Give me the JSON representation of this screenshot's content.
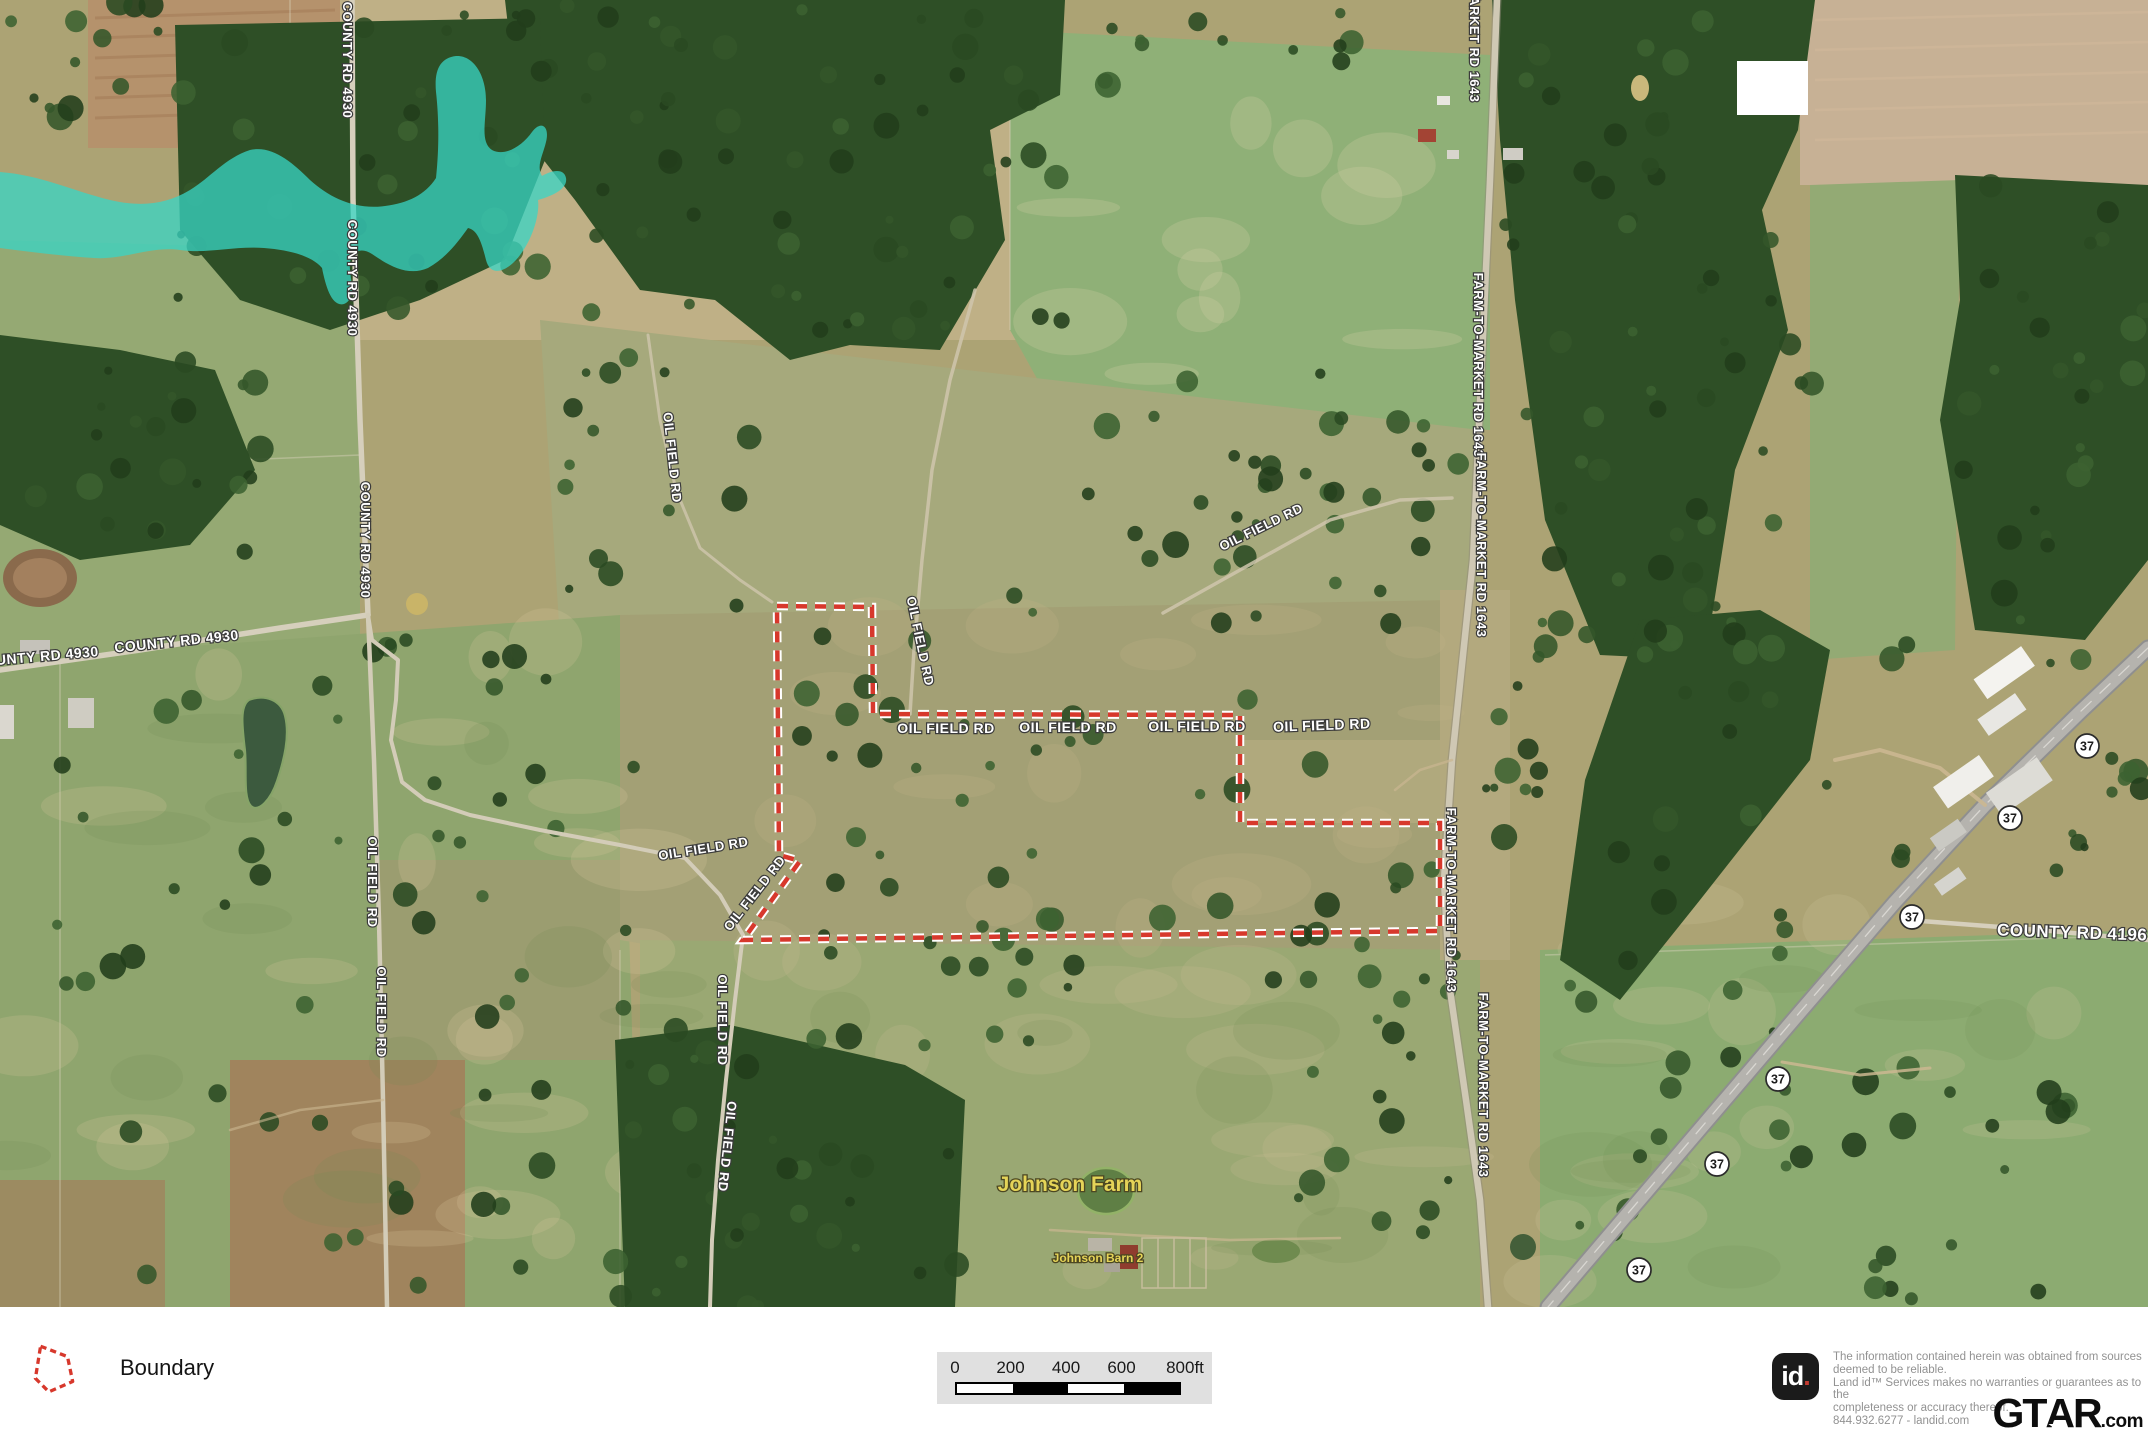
{
  "colors": {
    "boundary": "#d7382c",
    "boundary_casing": "#ffffff",
    "water": "#38d6c5",
    "road_label": "#ffffff",
    "farm_label": "#e5d458",
    "scale_bg": "#e0e0e0"
  },
  "map": {
    "boundary_points": "777,606 872,607 873,714 1240,715 1240,823 1440,823 1440,931 743,940 800,861 779,855",
    "road_labels": [
      {
        "text": "COUNTY RD 4930",
        "x": 343,
        "y": 60,
        "rot": 90,
        "size": 13
      },
      {
        "text": "COUNTY RD 4930",
        "x": 348,
        "y": 278,
        "rot": 90,
        "size": 13
      },
      {
        "text": "COUNTY RD 4930",
        "x": 361,
        "y": 540,
        "rot": 90,
        "size": 13
      },
      {
        "text": "OUNTY RD 4930",
        "x": 42,
        "y": 661,
        "rot": -5,
        "size": 14
      },
      {
        "text": "COUNTY RD 4930",
        "x": 177,
        "y": 646,
        "rot": -6,
        "size": 14
      },
      {
        "text": "OIL FIELD RD",
        "x": 368,
        "y": 882,
        "rot": 90,
        "size": 13
      },
      {
        "text": "OIL FIELD RD",
        "x": 377,
        "y": 1012,
        "rot": 90,
        "size": 13
      },
      {
        "text": "OIL FIELD RD",
        "x": 668,
        "y": 458,
        "rot": 84,
        "size": 13
      },
      {
        "text": "OIL FIELD RD",
        "x": 916,
        "y": 642,
        "rot": 78,
        "size": 13
      },
      {
        "text": "OIL FIELD RD",
        "x": 704,
        "y": 853,
        "rot": -9,
        "size": 13
      },
      {
        "text": "OIL FIELD RD",
        "x": 758,
        "y": 896,
        "rot": -52,
        "size": 13
      },
      {
        "text": "OIL FIELD RD",
        "x": 718,
        "y": 1020,
        "rot": 90,
        "size": 13
      },
      {
        "text": "OIL FIELD RD",
        "x": 723,
        "y": 1146,
        "rot": 96,
        "size": 13
      },
      {
        "text": "OIL FIELD RD",
        "x": 946,
        "y": 733,
        "rot": 0,
        "size": 14
      },
      {
        "text": "OIL FIELD RD",
        "x": 1068,
        "y": 732,
        "rot": 0,
        "size": 14
      },
      {
        "text": "OIL FIELD RD",
        "x": 1197,
        "y": 731,
        "rot": 0,
        "size": 14
      },
      {
        "text": "OIL FIELD RD",
        "x": 1322,
        "y": 730,
        "rot": -2,
        "size": 14
      },
      {
        "text": "OIL FIELD RD",
        "x": 1263,
        "y": 531,
        "rot": -26,
        "size": 13
      },
      {
        "text": "FARM-TO-MARKET RD 1643",
        "x": 1470,
        "y": 10,
        "rot": 90,
        "size": 13
      },
      {
        "text": "FARM-TO-MARKET RD 1643",
        "x": 1474,
        "y": 365,
        "rot": 90,
        "size": 13
      },
      {
        "text": "FARM-TO-MARKET RD 1643",
        "x": 1477,
        "y": 545,
        "rot": 90,
        "size": 13
      },
      {
        "text": "FARM-TO-MARKET RD 1643",
        "x": 1447,
        "y": 900,
        "rot": 90,
        "size": 13
      },
      {
        "text": "FARM-TO-MARKET RD 1643",
        "x": 1479,
        "y": 1085,
        "rot": 90,
        "size": 13
      },
      {
        "text": "COUNTY RD 4196",
        "x": 2072,
        "y": 938,
        "rot": 2,
        "size": 17
      }
    ],
    "shields": [
      {
        "num": "37",
        "x": 2087,
        "y": 746
      },
      {
        "num": "37",
        "x": 2010,
        "y": 818
      },
      {
        "num": "37",
        "x": 1912,
        "y": 917
      },
      {
        "num": "37",
        "x": 1778,
        "y": 1079
      },
      {
        "num": "37",
        "x": 1717,
        "y": 1164
      },
      {
        "num": "37",
        "x": 1639,
        "y": 1270
      }
    ],
    "poi_labels": [
      {
        "text": "Johnson Farm",
        "x": 1070,
        "y": 1191,
        "size": 21
      },
      {
        "text": "Johnson Barn 2",
        "x": 1098,
        "y": 1262,
        "size": 12
      }
    ]
  },
  "legend": {
    "boundary_label": "Boundary"
  },
  "scalebar": {
    "ticks": [
      "0",
      "200",
      "400",
      "600",
      "800ft"
    ]
  },
  "attribution": {
    "logo_text": "id",
    "logo_dot": ".",
    "disclaimer_lines": [
      "The information contained herein was obtained from sources",
      "deemed to be reliable.",
      "Land id™ Services makes no warranties or guarantees as to the",
      "completeness or accuracy thereof.",
      "844.932.6277 - landid.com"
    ],
    "brand_left": "GT",
    "brand_mid": "A",
    "brand_right": "R",
    "star": "★",
    "brand_suffix": ".com"
  }
}
